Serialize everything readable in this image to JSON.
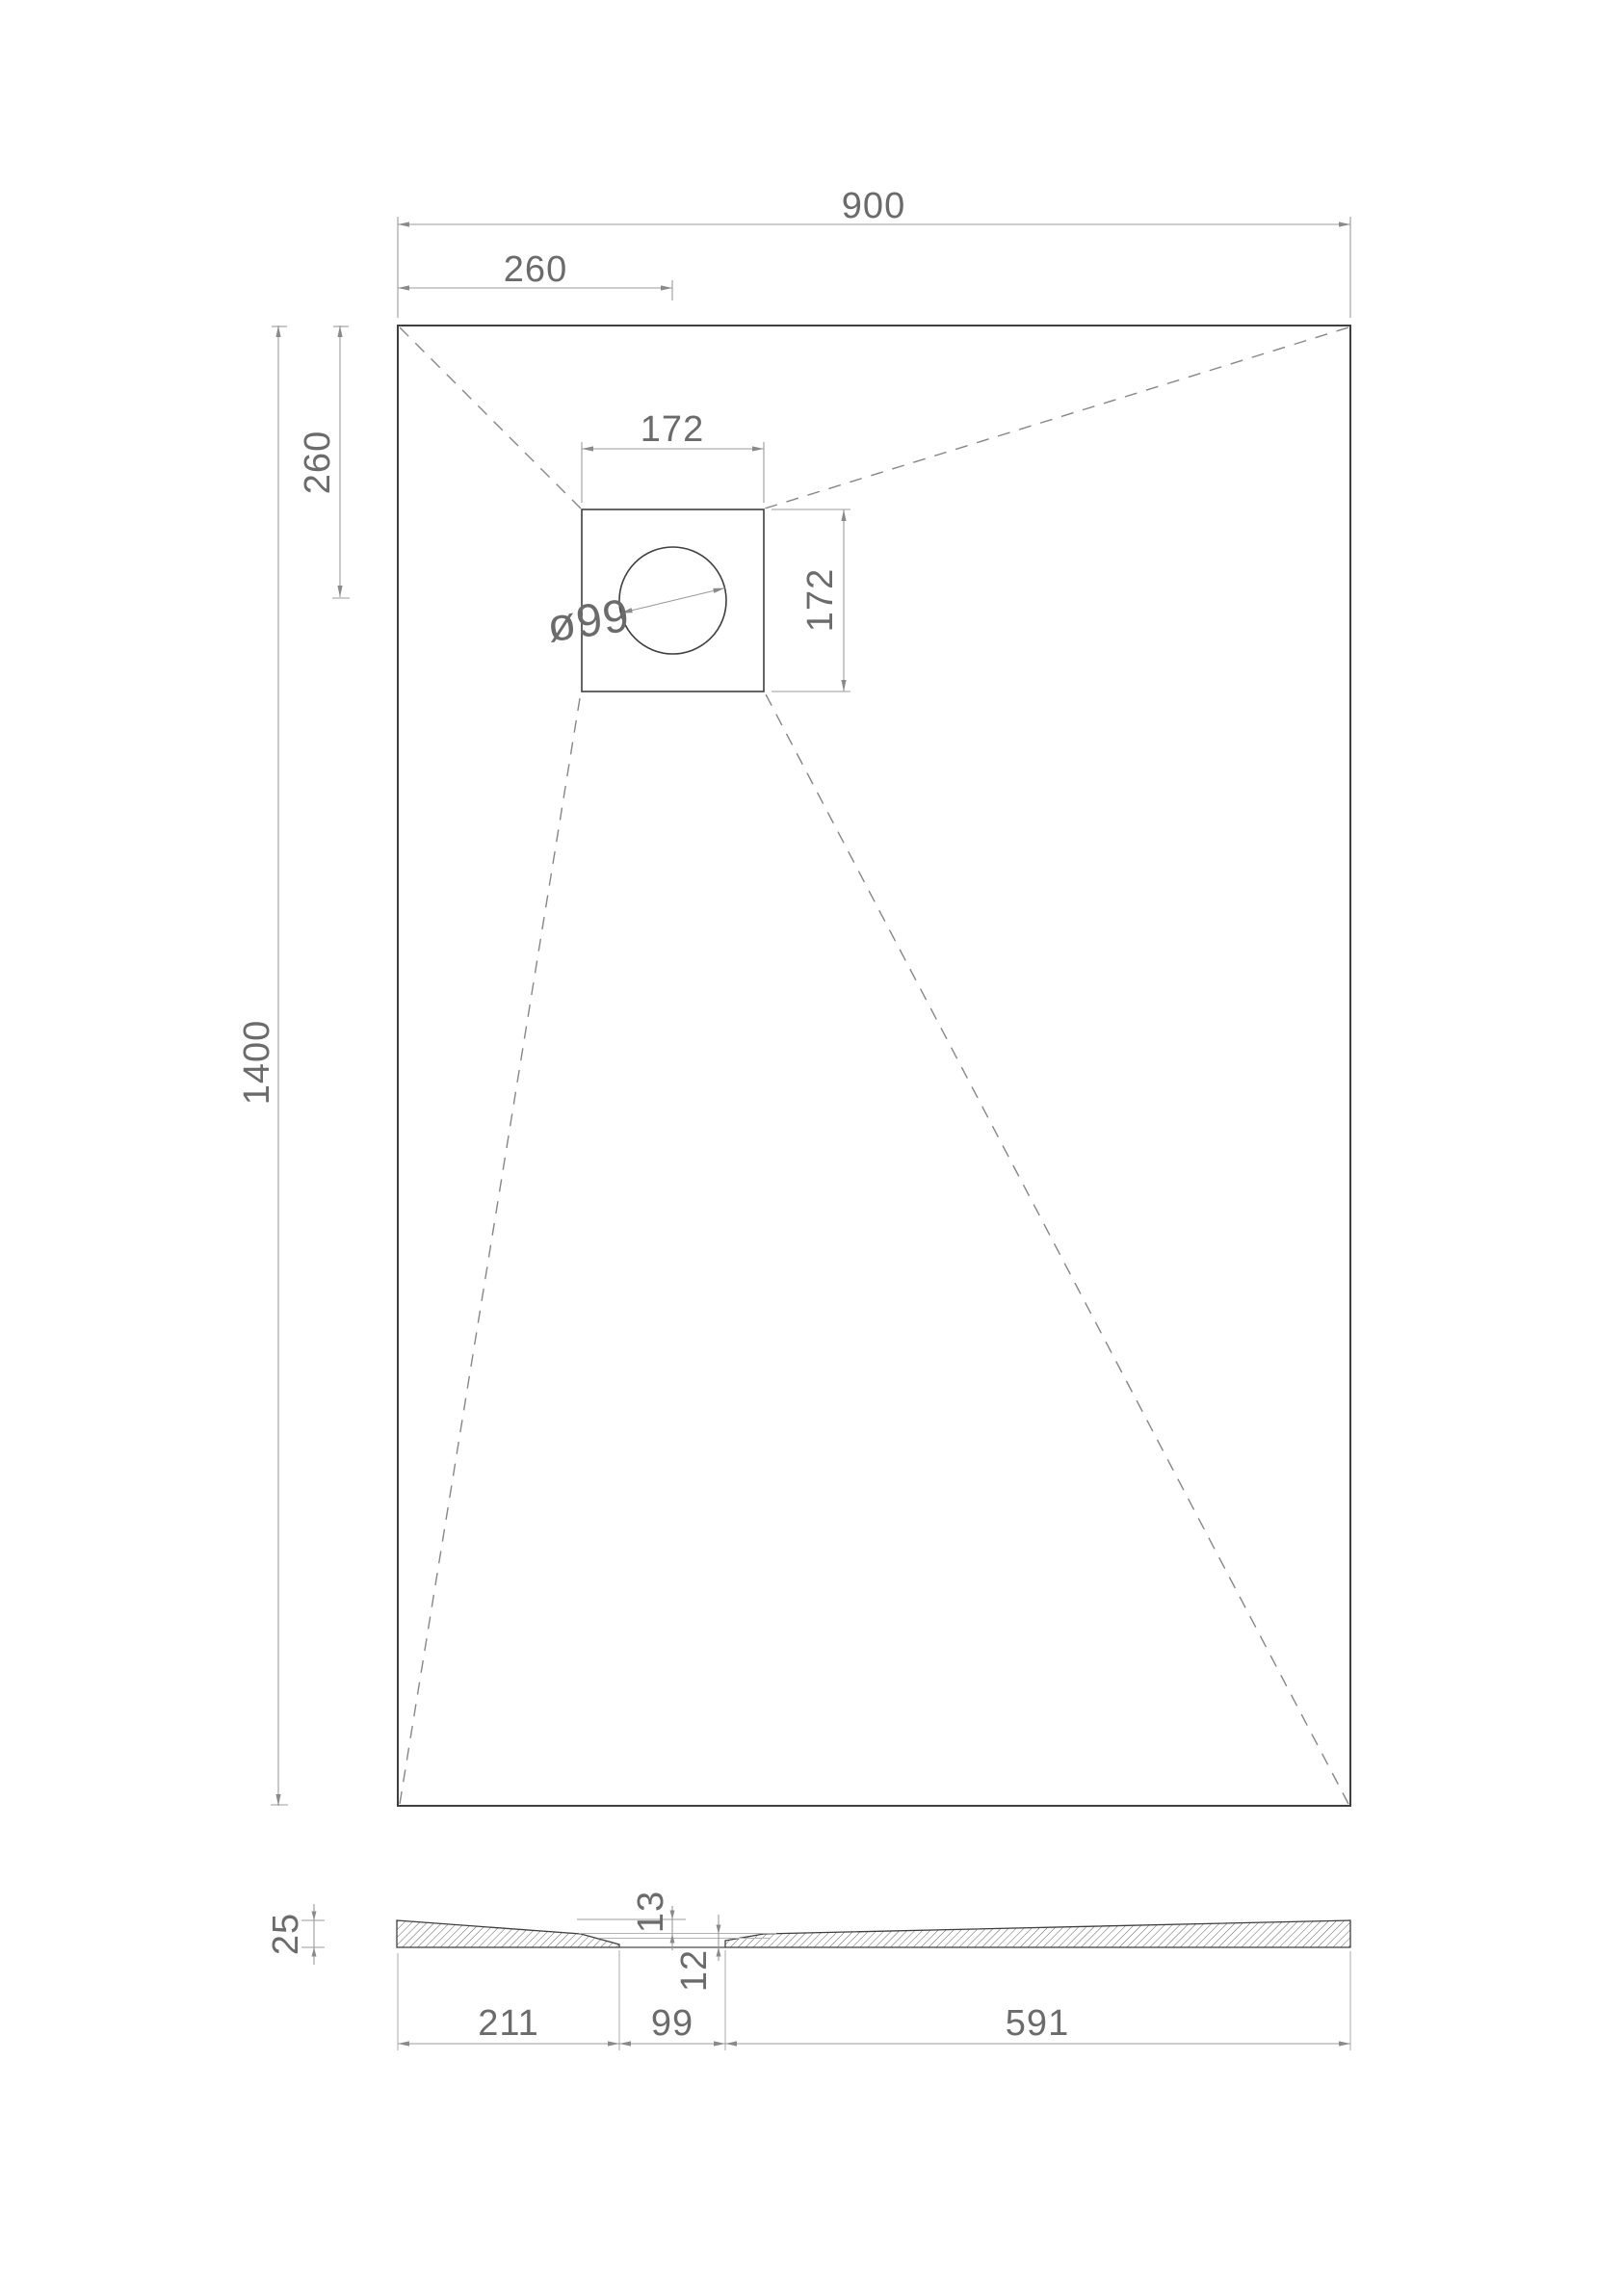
{
  "drawing_type": "shower-tray-technical-drawing",
  "plan": {
    "overall_width": "900",
    "drain_offset_from_left": "260",
    "drain_offset_from_top": "260",
    "overall_length": "1400",
    "drain_box_width": "172",
    "drain_box_height": "172",
    "drain_diameter": "ø99"
  },
  "section": {
    "edge_thickness": "25",
    "slope_drop": "13",
    "drain_thickness": "12",
    "span_left": "211",
    "span_drain": "99",
    "span_right": "591"
  },
  "colors": {
    "background": "#ffffff",
    "outline": "#3f3f3f",
    "dimension_lines": "#9b9b9b",
    "dimension_text": "#6b6b6b",
    "slope_dashes": "#868686",
    "hatch": "#4f4f4f"
  }
}
